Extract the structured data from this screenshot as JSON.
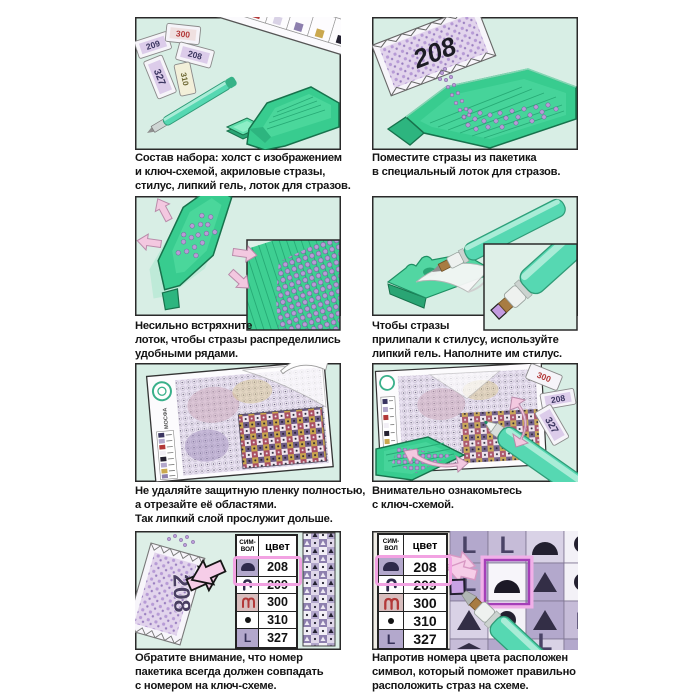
{
  "panels": [
    {
      "caption": "Состав набора: холст с изображением\nи ключ-схемой, акриловые стразы,\nстилус, липкий гель, лоток для стразов."
    },
    {
      "caption": "Поместите стразы из пакетика\nв специальный лоток для стразов."
    },
    {
      "caption": "Несильно встряхните\nлоток, чтобы стразы распределились\nудобными рядами."
    },
    {
      "caption": "Чтобы стразы\nприлипали к стилусу, используйте\nлипкий гель. Наполните им стилус."
    },
    {
      "caption": "Не удаляйте защитную пленку полностью,\nа отрезайте её областями.\nТак липкий слой прослужит дольше."
    },
    {
      "caption": "Внимательно ознакомьтесь\nс ключ-схемой."
    },
    {
      "caption": "Обратите внимание, что номер\nпакетика всегда должен совпадать\nс номером на ключ-схеме."
    },
    {
      "caption": "Напротив номера цвета расположен\nсимвол, который поможет правильно\nрасположить страз на схеме."
    }
  ],
  "packets": {
    "panel1": [
      "209",
      "300",
      "208",
      "327",
      "310"
    ],
    "panel2": "208",
    "panel6": [
      "300",
      "208",
      "327"
    ],
    "panel7": "208"
  },
  "key_table": {
    "symbol_header": "СИМ-\nВОЛ",
    "color_header": "цвет",
    "letter_l": "L",
    "rows": [
      {
        "symbol": "dome",
        "color": "208",
        "highlighted": true
      },
      {
        "symbol": "hook",
        "color": "209",
        "highlighted": false
      },
      {
        "symbol": "double-arch",
        "color": "300",
        "highlighted": false
      },
      {
        "symbol": "dot",
        "color": "310",
        "highlighted": false
      },
      {
        "symbol": "letter-L",
        "color": "327",
        "highlighted": false
      }
    ]
  },
  "brand": {
    "logo_text": "МОСФА"
  },
  "colors": {
    "panel_background": "#d8eee5",
    "frame_border": "#2a2a2a",
    "tray_green": "#38cc8f",
    "tray_dark_green": "#17724c",
    "stylus_teal": "#56d8b2",
    "arrow_pink": "#f3c8e0",
    "highlight_pink": "#f2a2e2",
    "rhinestone_purple": "#b79bd6",
    "symbol_navy": "#2f2a4c",
    "symbol_red": "#b23838",
    "cell_lavender": "#b3a8cc"
  }
}
